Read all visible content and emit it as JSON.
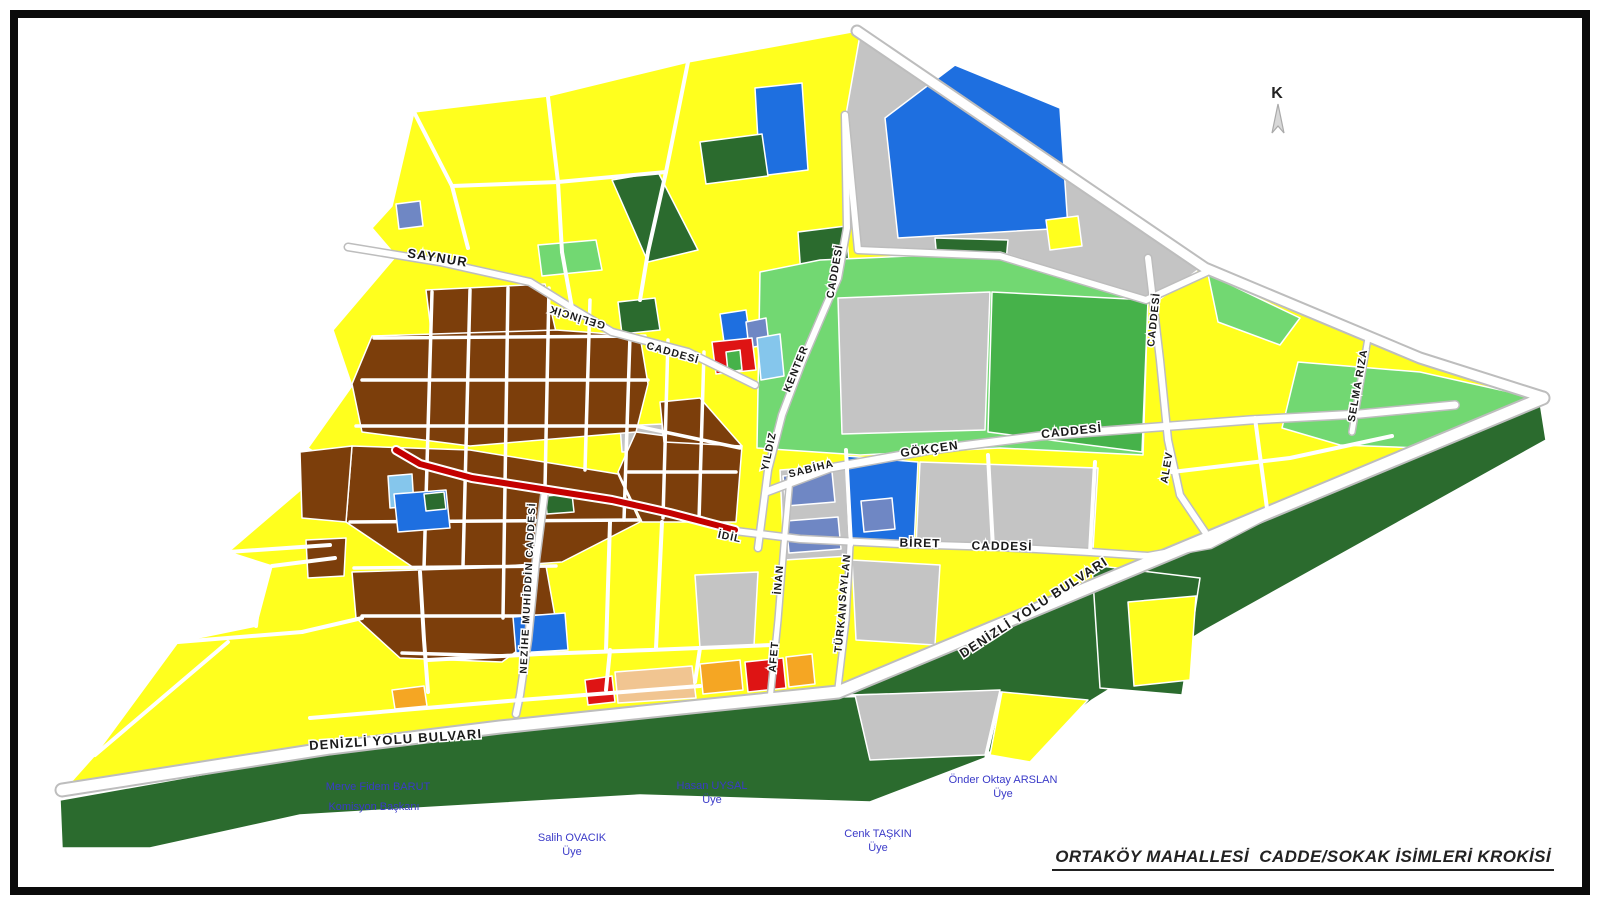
{
  "page": {
    "title": "ORTAKÖY MAHALLESİ  CADDE/SOKAK İSİMLERİ KROKİSİ",
    "north_label": "K"
  },
  "street_labels": {
    "saynur": "SAYNUR",
    "gelincik": "GELİNCİK",
    "gelincik_caddesi": "CADDESİ",
    "yildiz": "YILDIZ",
    "kenter": "KENTER",
    "kenter_caddesi": "CADDESİ",
    "sabiha": "SABİHA",
    "gokcen": "GÖKÇEN",
    "gokcen_caddesi": "CADDESİ",
    "idil": "İDİL",
    "biret": "BİRET",
    "biret_caddesi": "CADDESİ",
    "inan": "İNAN",
    "afet": "AFET",
    "saylan": "SAYLAN",
    "turkan": "TÜRKAN",
    "nezihe_muhiddin": "NEZİHE MUHİDDİN CADDESİ",
    "alev": "ALEV",
    "alev_caddesi": "CADDESİ",
    "selma": "SELMA RIZA",
    "denizli_bottom": "DENİZLİ YOLU BULVARI",
    "denizli_diagonal": "DENİZLİ YOLU BULVARI"
  },
  "committee": [
    {
      "name": "Merve Fidem BARUT",
      "role": "Komisyon Başkanı"
    },
    {
      "name": "Hasan UYSAL",
      "role": "Üye"
    },
    {
      "name": "Önder Oktay ARSLAN",
      "role": "Üye"
    },
    {
      "name": "Salih OVACIK",
      "role": "Üye"
    },
    {
      "name": "Cenk TAŞKIN",
      "role": "Üye"
    }
  ],
  "colors": {
    "yellow": "#FFFF1E",
    "brown": "#7C3E0B",
    "gray": "#C4C4C4",
    "blue": "#1E6FE0",
    "light_blue": "#85C6EC",
    "slate_blue": "#6F87C4",
    "light_green": "#72D872",
    "medium_green": "#46B24A",
    "dark_green": "#2B6B2E",
    "red": "#DE1414",
    "orange": "#F5A623",
    "tan": "#F1C591",
    "red_road": "#C40000",
    "road_casing": "#BDBDBD",
    "label": "#1A1A1A",
    "signature": "#3A3AC8"
  }
}
